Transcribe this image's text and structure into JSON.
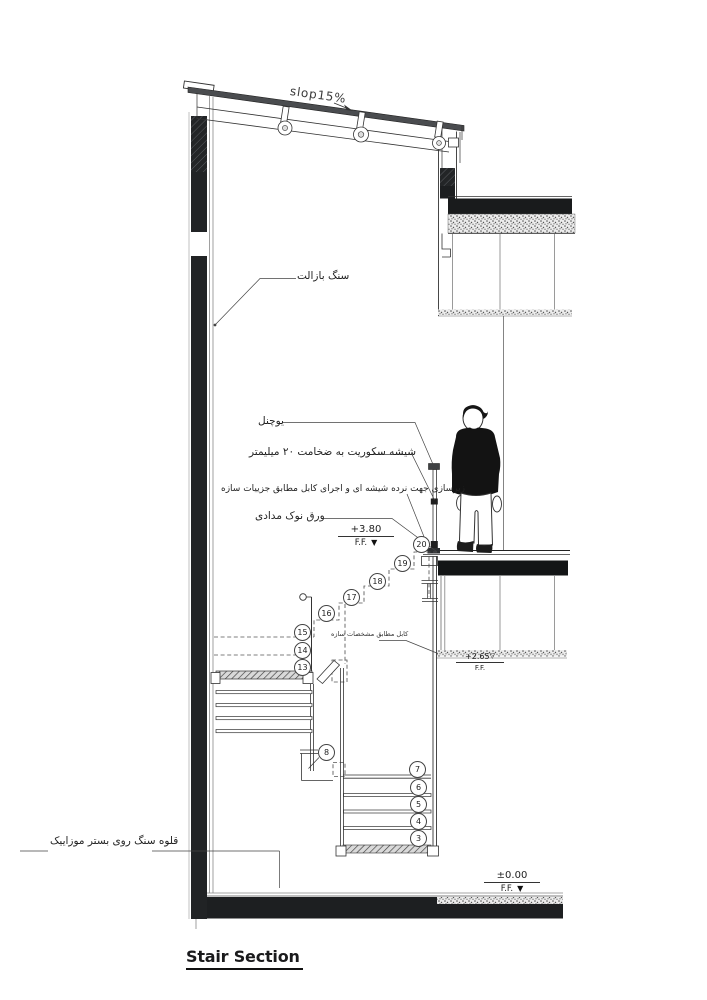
{
  "drawing": {
    "title": "Stair Section",
    "slope_label": "slop15%",
    "annotations": {
      "basalt": "سنگ بازالت",
      "u_channel": "یوچنل",
      "securit_glass": "شیشه سکوریت به ضخامت ۲۰ میلیمتر",
      "railing_substructure": "زیرسازی جهت نرده شیشه ای و اجرای کابل مطابق جزییات سازه",
      "graphite_sheet": "ورق نوک مدادی",
      "structural_cable": "کابل مطابق مشخصات سازه",
      "cobblestone": "قلوه سنگ روی بستر موزاییک"
    },
    "levels": {
      "upper": {
        "value": "+3.80",
        "datum": "F.F."
      },
      "middle": {
        "value": "+2.65",
        "datum": "F.F."
      },
      "ground": {
        "value": "±0.00",
        "datum": "F.F."
      }
    },
    "step_markers": [
      "3",
      "4",
      "5",
      "6",
      "7",
      "8",
      "13",
      "14",
      "15",
      "16",
      "17",
      "18",
      "19",
      "20"
    ],
    "colors": {
      "ink": "#1d1f21",
      "line_gray": "#777777"
    }
  }
}
